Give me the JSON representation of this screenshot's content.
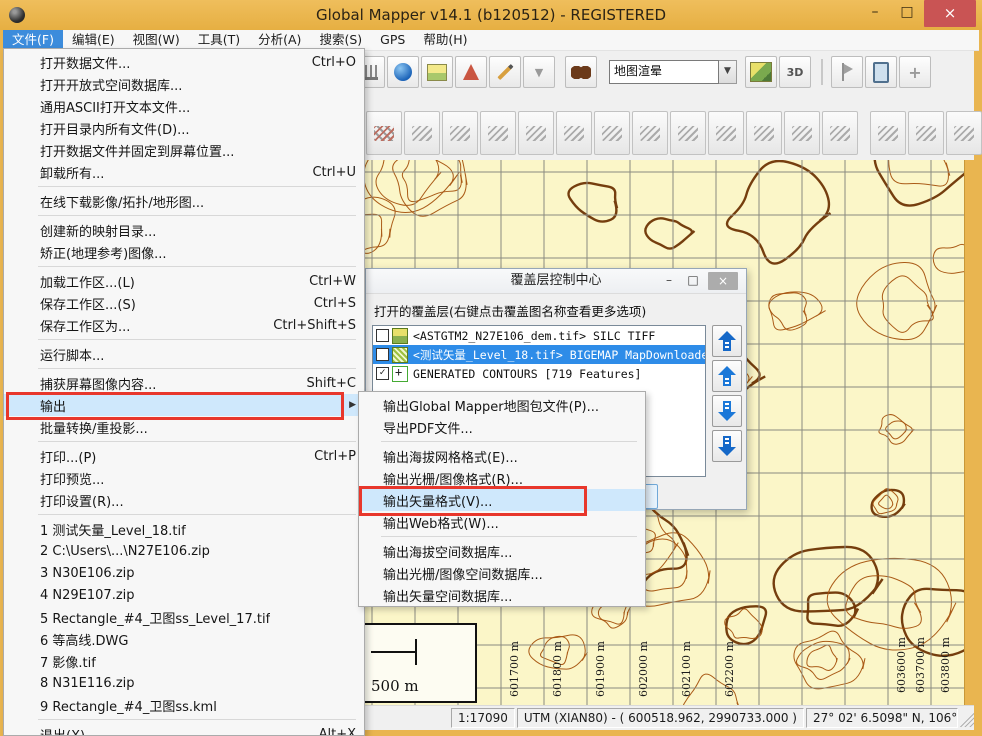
{
  "window": {
    "title": "Global Mapper v14.1 (b120512) - REGISTERED",
    "controls": {
      "minimize": "–",
      "maximize": "□",
      "close": "×"
    }
  },
  "menubar": {
    "items": [
      {
        "label": "文件(F)",
        "active": true
      },
      {
        "label": "编辑(E)",
        "active": false
      },
      {
        "label": "视图(W)",
        "active": false
      },
      {
        "label": "工具(T)",
        "active": false
      },
      {
        "label": "分析(A)",
        "active": false
      },
      {
        "label": "搜索(S)",
        "active": false
      },
      {
        "label": "GPS",
        "active": false
      },
      {
        "label": "帮助(H)",
        "active": false
      }
    ]
  },
  "toolbar": {
    "shader_value": "地图渲晕",
    "icons": [
      "measure-icon",
      "globe-cursor-icon",
      "terrain-image-icon",
      "antenna-icon",
      "pencil-icon",
      "dropdown-arrow-icon",
      "binoculars-icon",
      "terrain-shader-icon",
      "3d-view-icon",
      "flag-icon",
      "gps-device-icon",
      "path-profile-icon"
    ],
    "digitizer_button_count": 16
  },
  "file_menu": {
    "items": [
      {
        "label": "打开数据文件...",
        "shortcut": "Ctrl+O"
      },
      {
        "label": "打开开放式空间数据库..."
      },
      {
        "label": "通用ASCII打开文本文件..."
      },
      {
        "label": "打开目录内所有文件(D)..."
      },
      {
        "label": "打开数据文件并固定到屏幕位置..."
      },
      {
        "label": "卸载所有...",
        "shortcut": "Ctrl+U"
      },
      {
        "type": "separator"
      },
      {
        "label": "在线下载影像/拓扑/地形图..."
      },
      {
        "type": "separator"
      },
      {
        "label": "创建新的映射目录..."
      },
      {
        "label": "矫正(地理参考)图像..."
      },
      {
        "type": "separator"
      },
      {
        "label": "加载工作区...(L)",
        "shortcut": "Ctrl+W"
      },
      {
        "label": "保存工作区...(S)",
        "shortcut": "Ctrl+S"
      },
      {
        "label": "保存工作区为...",
        "shortcut": "Ctrl+Shift+S"
      },
      {
        "type": "separator"
      },
      {
        "label": "运行脚本..."
      },
      {
        "type": "separator"
      },
      {
        "label": "捕获屏幕图像内容...",
        "shortcut": "Shift+C"
      },
      {
        "label": "输出",
        "highlighted": true,
        "submenu": true
      },
      {
        "label": "批量转换/重投影..."
      },
      {
        "type": "separator"
      },
      {
        "label": "打印...(P)",
        "shortcut": "Ctrl+P"
      },
      {
        "label": "打印预览..."
      },
      {
        "label": "打印设置(R)..."
      },
      {
        "type": "separator"
      },
      {
        "label": "1 测试矢量_Level_18.tif"
      },
      {
        "label": "2 C:\\Users\\...\\N27E106.zip"
      },
      {
        "label": "3 N30E106.zip"
      },
      {
        "label": "4 N29E107.zip"
      },
      {
        "label": "5 Rectangle_#4_卫图ss_Level_17.tif"
      },
      {
        "label": "6 等高线.DWG"
      },
      {
        "label": "7 影像.tif"
      },
      {
        "label": "8 N31E116.zip"
      },
      {
        "label": "9 Rectangle_#4_卫图ss.kml"
      },
      {
        "type": "separator"
      },
      {
        "label": "退出(X)",
        "shortcut": "Alt+X"
      }
    ]
  },
  "export_submenu": {
    "items": [
      {
        "label": "输出Global Mapper地图包文件(P)..."
      },
      {
        "label": "导出PDF文件..."
      },
      {
        "type": "separator"
      },
      {
        "label": "输出海拔网格格式(E)..."
      },
      {
        "label": "输出光栅/图像格式(R)..."
      },
      {
        "label": "输出矢量格式(V)...",
        "highlighted": true
      },
      {
        "label": "输出Web格式(W)..."
      },
      {
        "type": "separator"
      },
      {
        "label": "输出海拔空间数据库..."
      },
      {
        "label": "输出光栅/图像空间数据库..."
      },
      {
        "label": "输出矢量空间数据库..."
      }
    ]
  },
  "overlay_dialog": {
    "title": "覆盖层控制中心",
    "controls": {
      "minimize": "–",
      "maximize": "□",
      "close": "×"
    },
    "instruction": "打开的覆盖层(右键点击覆盖图名称查看更多选项)",
    "layers": [
      {
        "checked": false,
        "selected": false,
        "icon": "raster-layer-icon",
        "name": "<ASTGTM2_N27E106_dem.tif> SILC TIFF"
      },
      {
        "checked": false,
        "selected": true,
        "icon": "map-tile-layer-icon",
        "name": "<测试矢量_Level_18.tif> BIGEMAP MapDownloader"
      },
      {
        "checked": true,
        "selected": false,
        "icon": "contours-layer-icon",
        "name": "GENERATED CONTOURS [719 Features]"
      }
    ]
  },
  "map": {
    "scale_bar": "500 m",
    "bottom_labels": [
      "601400 m",
      "601500 m",
      "601600 m",
      "601700 m",
      "601800 m",
      "601900 m",
      "602000 m",
      "602100 m",
      "602200 m"
    ],
    "right_labels": [
      "603600 m",
      "603700 m",
      "603800 m"
    ],
    "colors": {
      "background": "#FBF6C8",
      "grid": "#8A8A80",
      "contour_thin": "#A5520E",
      "contour_thick": "#6E3404"
    }
  },
  "statusbar": {
    "scale": "1:17090",
    "projection": "UTM (XIAN80) - ( 600518.962, 2990733.000 )",
    "position": "27° 02' 6.5098\" N, 106°"
  },
  "annotations": {
    "color": "#E8372C"
  }
}
